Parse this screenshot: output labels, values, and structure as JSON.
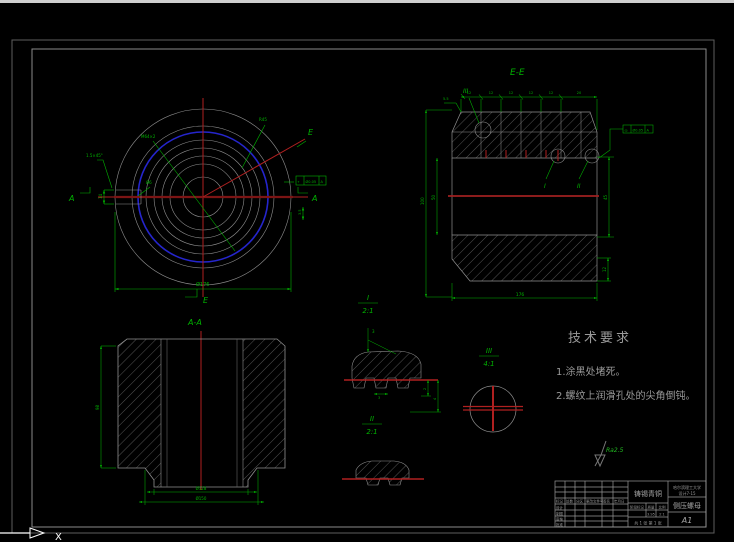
{
  "colors": {
    "background": "#000000",
    "dim_green": "#00b300",
    "centerline_red": "#b02020",
    "thread_blue": "#2525cc",
    "outline_gray": "#8f8f8f",
    "note_gray": "#9a9a9a",
    "ucs_white": "#ffffff"
  },
  "front_view": {
    "label_e_top": "E",
    "label_e_bottom": "E",
    "label_a_left": "A",
    "label_a_right": "A",
    "chamfer_label": "1.5×45°",
    "thread_label": "M64×2",
    "radius_label": "R45",
    "hole_label": "Ø6",
    "keyway_dim": "14",
    "side_dim": "3.5",
    "width_dim": "Ø176",
    "fcf": {
      "sym": "⌖",
      "tol": "Ø0.05",
      "datum": "A"
    }
  },
  "section_ee": {
    "title": "E-E",
    "top_dims": [
      "12",
      "12",
      "12",
      "12",
      "12",
      "20"
    ],
    "corner_dim": "5.5",
    "height_dim": "100",
    "band_dim": "50",
    "right_dim_upper": "45",
    "right_dim_lower": "12",
    "bottom_dim": "176",
    "detail_i_label": "I",
    "detail_ii_label": "II",
    "detail_iii_label": "III",
    "fcf": {
      "sym": "◎",
      "tol": "Ø0.05",
      "datum": "A"
    }
  },
  "section_aa": {
    "title": "A-A",
    "height_dim": "98",
    "inner_dim": "Ø128",
    "outer_dim": "Ø150"
  },
  "detail_i": {
    "label": "I",
    "scale": "2:1",
    "dim_top": "3",
    "dim_tooth": "3",
    "dim_r1": "2",
    "dim_r2": "4"
  },
  "detail_ii": {
    "label": "II",
    "scale": "2:1"
  },
  "detail_iii": {
    "label": "III",
    "scale": "4:1"
  },
  "tech_req": {
    "heading": "技术要求",
    "notes": [
      "1.涂黑处堵死。",
      "2.螺纹上润滑孔处的尖角倒钝。"
    ]
  },
  "roughness": {
    "value": "Ra2.5"
  },
  "title_block": {
    "material": "铸锡青铜",
    "part_name": "侧压螺母",
    "sheet": "A1",
    "org_line1": "哈尔滨理工大学",
    "org_line2": "设计7-15",
    "rev_labels": [
      "标记",
      "处数",
      "分区",
      "更改文件号",
      "签名",
      "年月日"
    ],
    "staff_labels": [
      "设计",
      "制图",
      "审核",
      "批准"
    ],
    "field_labels": [
      "阶段标记",
      "质量",
      "比例"
    ],
    "weight_value": "3.95",
    "scale_value": "2:1",
    "sheet_info": "共 1 张  第 1 张"
  },
  "ucs": {
    "x_label": "X"
  }
}
